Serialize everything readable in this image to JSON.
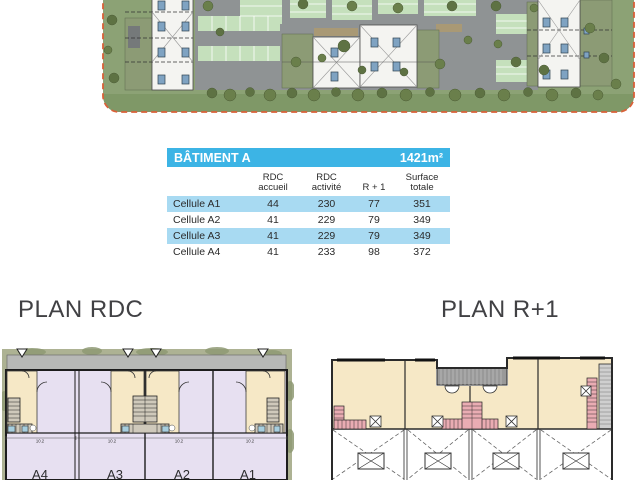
{
  "table": {
    "title": "BÂTIMENT A",
    "total_area": "1421m²",
    "columns": [
      {
        "l1": "RDC",
        "l2": "accueil"
      },
      {
        "l1": "RDC",
        "l2": "activité"
      },
      {
        "l1": "",
        "l2": "R + 1"
      },
      {
        "l1": "Surface",
        "l2": "totale"
      }
    ],
    "rows": [
      {
        "label": "Cellule A1",
        "values": [
          "44",
          "230",
          "77",
          "351"
        ]
      },
      {
        "label": "Cellule A2",
        "values": [
          "41",
          "229",
          "79",
          "349"
        ]
      },
      {
        "label": "Cellule A3",
        "values": [
          "41",
          "229",
          "79",
          "349"
        ]
      },
      {
        "label": "Cellule A4",
        "values": [
          "41",
          "233",
          "98",
          "372"
        ]
      }
    ]
  },
  "plan_rdc": {
    "title": "PLAN RDC",
    "cell_labels": [
      "A4",
      "A3",
      "A2",
      "A1"
    ],
    "dimensions": [
      "10.2",
      "10.2",
      "10.2",
      "10.2"
    ]
  },
  "plan_r1": {
    "title": "PLAN R+1"
  },
  "colors": {
    "accent_cyan": "#3CB4E5",
    "row_highlight": "#A8DAF2",
    "accueil_cream": "#F6E8C6",
    "activite_lavender": "#E7E0F1",
    "site_boundary_orange": "#D96038"
  }
}
